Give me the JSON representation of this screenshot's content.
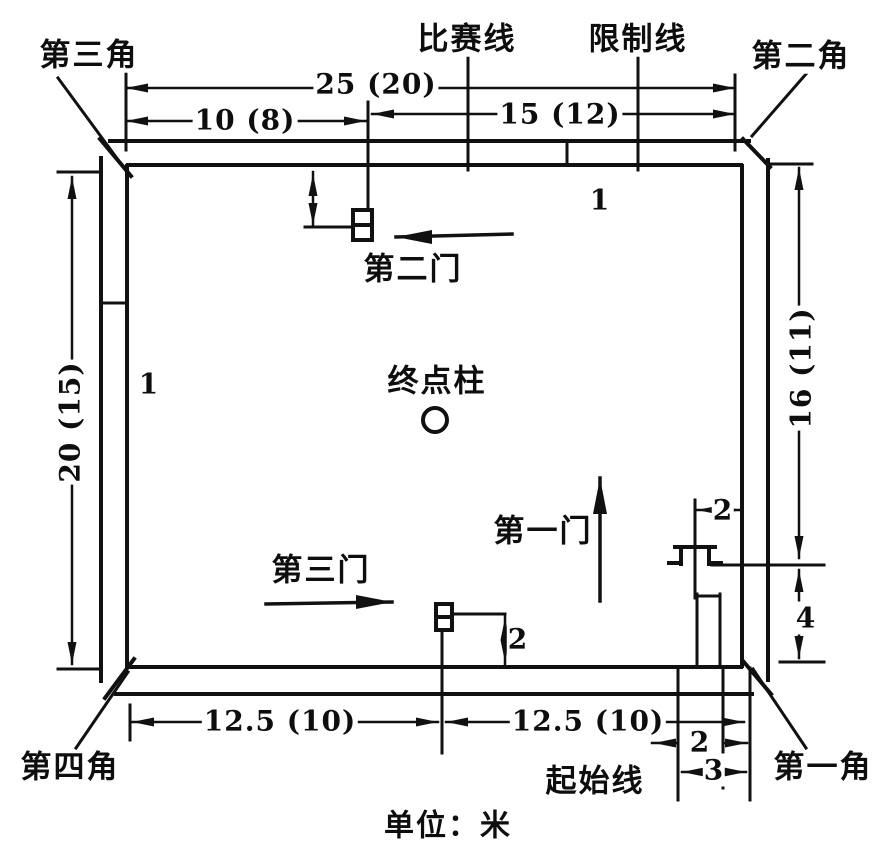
{
  "unit_note": "单位：米",
  "corners": {
    "c1": "第一角",
    "c2": "第二角",
    "c3": "第三角",
    "c4": "第四角"
  },
  "course_lines": {
    "competition": "比赛线",
    "limit": "限制线",
    "start": "起始线"
  },
  "gates": {
    "g1": "第一门",
    "g2": "第二门",
    "g3": "第三门"
  },
  "finish_post": "终点柱",
  "dims": {
    "top_total": "25 (20)",
    "top_left": "10 (8)",
    "top_right": "15 (12)",
    "left_height": "20 (15)",
    "right_height": "16 (11)",
    "bottom_left": "12.5 (10)",
    "bottom_right": "12.5 (10)",
    "right_corner_height": "4",
    "gate1_to_wall": "2",
    "gate3_to_wall": "2",
    "start_gate_width": "2",
    "start_zone_width": "3",
    "wall_line_top": "1",
    "wall_line_left": "1"
  }
}
